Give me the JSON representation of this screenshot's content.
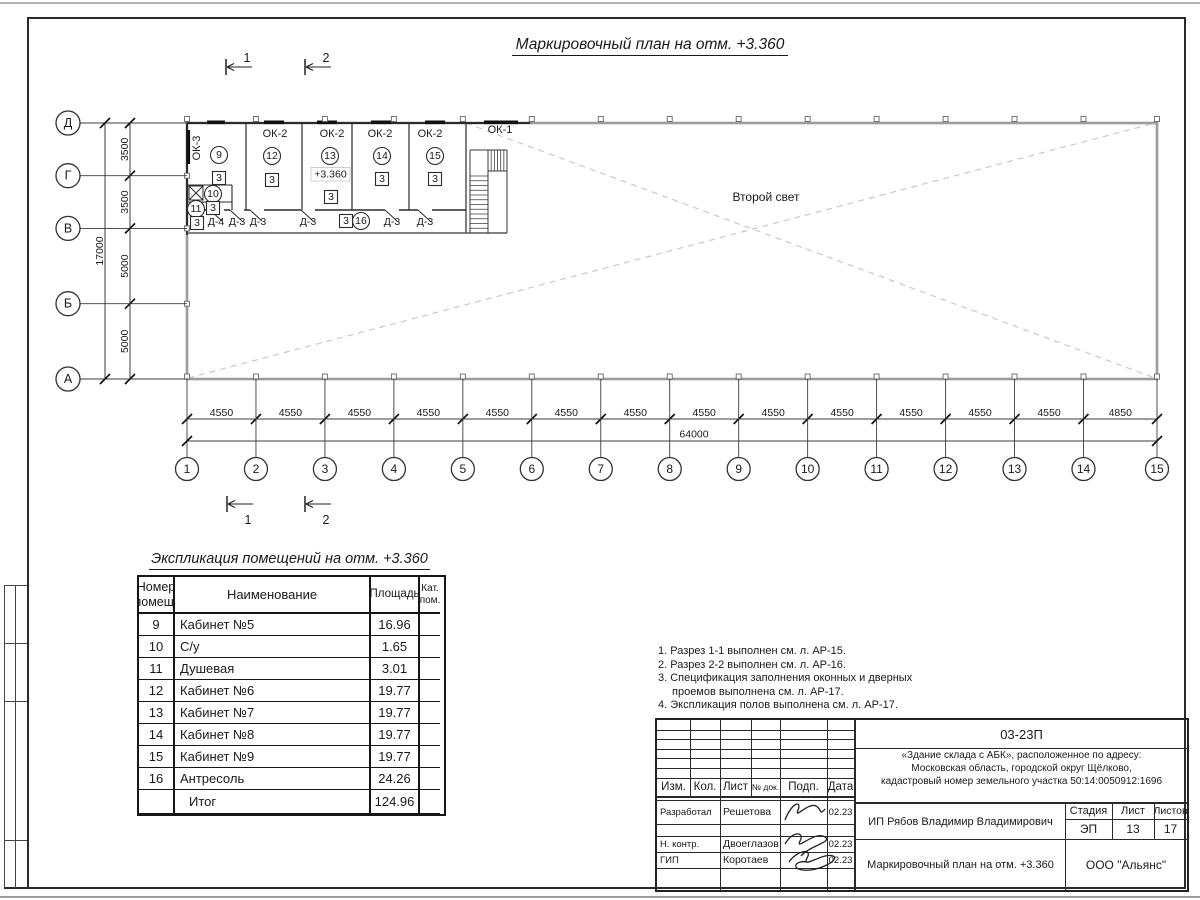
{
  "page": {
    "drawing_title": "Маркировочный план на отм. +3.360",
    "explication_title": "Экспликация помещений на отм. +3.360"
  },
  "plan": {
    "second_light_label": "Второй свет",
    "elevation_label": "+3.360",
    "section_labels": [
      "1",
      "2"
    ],
    "column_axes": [
      "1",
      "2",
      "3",
      "4",
      "5",
      "6",
      "7",
      "8",
      "9",
      "10",
      "11",
      "12",
      "13",
      "14",
      "15"
    ],
    "column_spans": [
      "4550",
      "4550",
      "4550",
      "4550",
      "4550",
      "4550",
      "4550",
      "4550",
      "4550",
      "4550",
      "4550",
      "4550",
      "4550",
      "4850"
    ],
    "column_total": "64000",
    "row_axes": [
      "Д",
      "Г",
      "В",
      "Б",
      "А"
    ],
    "row_spans": [
      "3500",
      "3500",
      "5000",
      "5000"
    ],
    "row_total": "17000",
    "window_marks": [
      {
        "label": "ОК-3",
        "x": 197,
        "y": 148,
        "rot": true
      },
      {
        "label": "ОК-2",
        "x": 275,
        "y": 134
      },
      {
        "label": "ОК-2",
        "x": 332,
        "y": 134
      },
      {
        "label": "ОК-2",
        "x": 380,
        "y": 134
      },
      {
        "label": "ОК-2",
        "x": 430,
        "y": 134
      },
      {
        "label": "ОК-1",
        "x": 500,
        "y": 130
      }
    ],
    "room_circles": [
      {
        "n": "9",
        "x": 219,
        "y": 155
      },
      {
        "n": "12",
        "x": 272,
        "y": 156
      },
      {
        "n": "13",
        "x": 330,
        "y": 156
      },
      {
        "n": "14",
        "x": 382,
        "y": 156
      },
      {
        "n": "15",
        "x": 435,
        "y": 156
      },
      {
        "n": "10",
        "x": 213,
        "y": 194
      },
      {
        "n": "11",
        "x": 196,
        "y": 209
      },
      {
        "n": "16",
        "x": 361,
        "y": 221
      }
    ],
    "floor_marks": [
      {
        "n": "3",
        "x": 219,
        "y": 178
      },
      {
        "n": "3",
        "x": 272,
        "y": 180
      },
      {
        "n": "3",
        "x": 331,
        "y": 197
      },
      {
        "n": "3",
        "x": 382,
        "y": 179
      },
      {
        "n": "3",
        "x": 435,
        "y": 179
      },
      {
        "n": "3",
        "x": 213,
        "y": 208
      },
      {
        "n": "3",
        "x": 197,
        "y": 223
      },
      {
        "n": "3",
        "x": 346,
        "y": 221
      }
    ],
    "door_labels": [
      {
        "label": "Д-4",
        "x": 216
      },
      {
        "label": "Д-3",
        "x": 237
      },
      {
        "label": "Д-3",
        "x": 258
      },
      {
        "label": "Д-3",
        "x": 308
      },
      {
        "label": "Д-3",
        "x": 392
      },
      {
        "label": "Д-3",
        "x": 425
      }
    ]
  },
  "explication": {
    "headers": [
      "Номер помещ.",
      "Наименование",
      "Площадь",
      "Кат. пом."
    ],
    "rows": [
      [
        "9",
        "Кабинет №5",
        "16.96",
        ""
      ],
      [
        "10",
        "С/у",
        "1.65",
        ""
      ],
      [
        "11",
        "Душевая",
        "3.01",
        ""
      ],
      [
        "12",
        "Кабинет №6",
        "19.77",
        ""
      ],
      [
        "13",
        "Кабинет №7",
        "19.77",
        ""
      ],
      [
        "14",
        "Кабинет №8",
        "19.77",
        ""
      ],
      [
        "15",
        "Кабинет №9",
        "19.77",
        ""
      ],
      [
        "16",
        "Антресоль",
        "24.26",
        ""
      ],
      [
        "",
        "Итог",
        "124.96",
        ""
      ]
    ]
  },
  "notes": [
    "1. Разрез 1-1 выполнен см. л. АР-15.",
    "2. Разрез 2-2 выполнен см. л. АР-16.",
    "3. Спецификация заполнения оконных и дверных",
    "проемов выполнена см. л. АР-17.",
    "4. Экспликация полов выполнена см. л. АР-17."
  ],
  "titleblock": {
    "doc_number": "03-23П",
    "project": [
      "«Здание склада с АБК», расположенное по адресу:",
      "Московская область, городской округ Щёлково,",
      "кадастровый номер земельного участка 50:14:0050912:1696"
    ],
    "client": "ИП Рябов Владимир Владимирович",
    "sheet_title": "Маркировочный план на отм. +3.360",
    "company": "ООО \"Альянс\"",
    "cols": [
      "Изм.",
      "Кол.",
      "Лист",
      "№ док.",
      "Подп.",
      "Дата"
    ],
    "stage_label": "Стадия",
    "sheet_label": "Лист",
    "sheets_label": "Листов",
    "stage": "ЭП",
    "sheet": "13",
    "sheets": "17",
    "roles": [
      {
        "role": "Разработал",
        "name": "Решетова",
        "date": "02.23"
      },
      {
        "role": "Н. контр.",
        "name": "Двоеглазов",
        "date": "02.23"
      },
      {
        "role": "ГИП",
        "name": "Коротаев",
        "date": "02.23"
      }
    ]
  }
}
